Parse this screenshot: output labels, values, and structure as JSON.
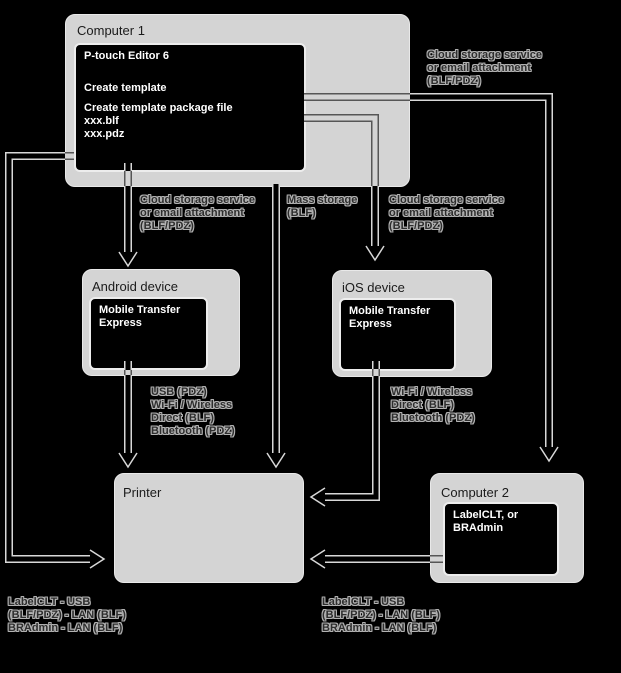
{
  "canvas": {
    "background": "#000000"
  },
  "colors": {
    "node_fill": "#d4d4d4",
    "node_border": "#e9e9e9",
    "inner_fill": "#000000",
    "inner_border": "#ededed",
    "inner_text": "#ffffff",
    "title_text": "#1b1b1b",
    "label_text": "#2e2e2e",
    "label_outline": "#b3b3b3",
    "arrow_outline": "#d8d8d8"
  },
  "nodes": {
    "computer1": {
      "title": "Computer 1",
      "app": {
        "name": "P-touch Editor 6",
        "lines": [
          "Create template",
          "Create template package file",
          "xxx.blf",
          "xxx.pdz"
        ]
      }
    },
    "android": {
      "title": "Android device",
      "app": {
        "lines": [
          "Mobile Transfer",
          "Express"
        ]
      }
    },
    "ios": {
      "title": "iOS device",
      "app": {
        "lines": [
          "Mobile Transfer",
          "Express"
        ]
      }
    },
    "printer": {
      "title": "Printer"
    },
    "computer2": {
      "title": "Computer 2",
      "app": {
        "lines": [
          "LabelCLT, or",
          "BRAdmin"
        ]
      }
    }
  },
  "labels": {
    "cloud_top_right": {
      "lines": [
        "Cloud storage service",
        "or email attachment",
        "(BLF/PDZ)"
      ]
    },
    "cloud_android": {
      "lines": [
        "Cloud storage service",
        "or email attachment",
        "(BLF/PDZ)"
      ]
    },
    "mass_storage": {
      "lines": [
        "Mass storage",
        "(BLF)"
      ]
    },
    "cloud_ios": {
      "lines": [
        "Cloud storage service",
        "or email attachment",
        "(BLF/PDZ)"
      ]
    },
    "usb_android": {
      "lines": [
        "USB (PDZ)",
        "Wi-Fi / Wireless",
        "Direct (BLF)",
        "Bluetooth (PDZ)"
      ]
    },
    "wifi_ios": {
      "lines": [
        "Wi-Fi / Wireless",
        "Direct (BLF)",
        "Bluetooth (PDZ)"
      ]
    },
    "labelclt_left": {
      "lines": [
        "LabelCLT - USB",
        "(BLF/PDZ) - LAN (BLF)",
        "BRAdmin - LAN (BLF)"
      ]
    },
    "labelclt_center": {
      "lines": [
        "LabelCLT - USB",
        "(BLF/PDZ) - LAN (BLF)",
        "BRAdmin - LAN (BLF)"
      ]
    }
  },
  "connections": [
    {
      "from": "Computer 1",
      "to": "Computer 2",
      "label": "Cloud storage service or email attachment (BLF/PDZ)"
    },
    {
      "from": "Computer 1",
      "to": "iOS device",
      "label": "Cloud storage service or email attachment (BLF/PDZ)"
    },
    {
      "from": "Computer 1",
      "to": "Android device",
      "label": "Cloud storage service or email attachment (BLF/PDZ)"
    },
    {
      "from": "Computer 1",
      "to": "Printer",
      "label": "Mass storage (BLF)"
    },
    {
      "from": "Computer 1",
      "to": "Printer",
      "label": "LabelCLT - USB (BLF/PDZ) - LAN (BLF), BRAdmin - LAN (BLF)"
    },
    {
      "from": "Android device",
      "to": "Printer",
      "label": "USB (PDZ), Wi-Fi / Wireless Direct (BLF), Bluetooth (PDZ)"
    },
    {
      "from": "iOS device",
      "to": "Printer",
      "label": "Wi-Fi / Wireless Direct (BLF), Bluetooth (PDZ)"
    },
    {
      "from": "Computer 2",
      "to": "Printer",
      "label": "LabelCLT - USB (BLF/PDZ) - LAN (BLF), BRAdmin - LAN (BLF)"
    }
  ]
}
